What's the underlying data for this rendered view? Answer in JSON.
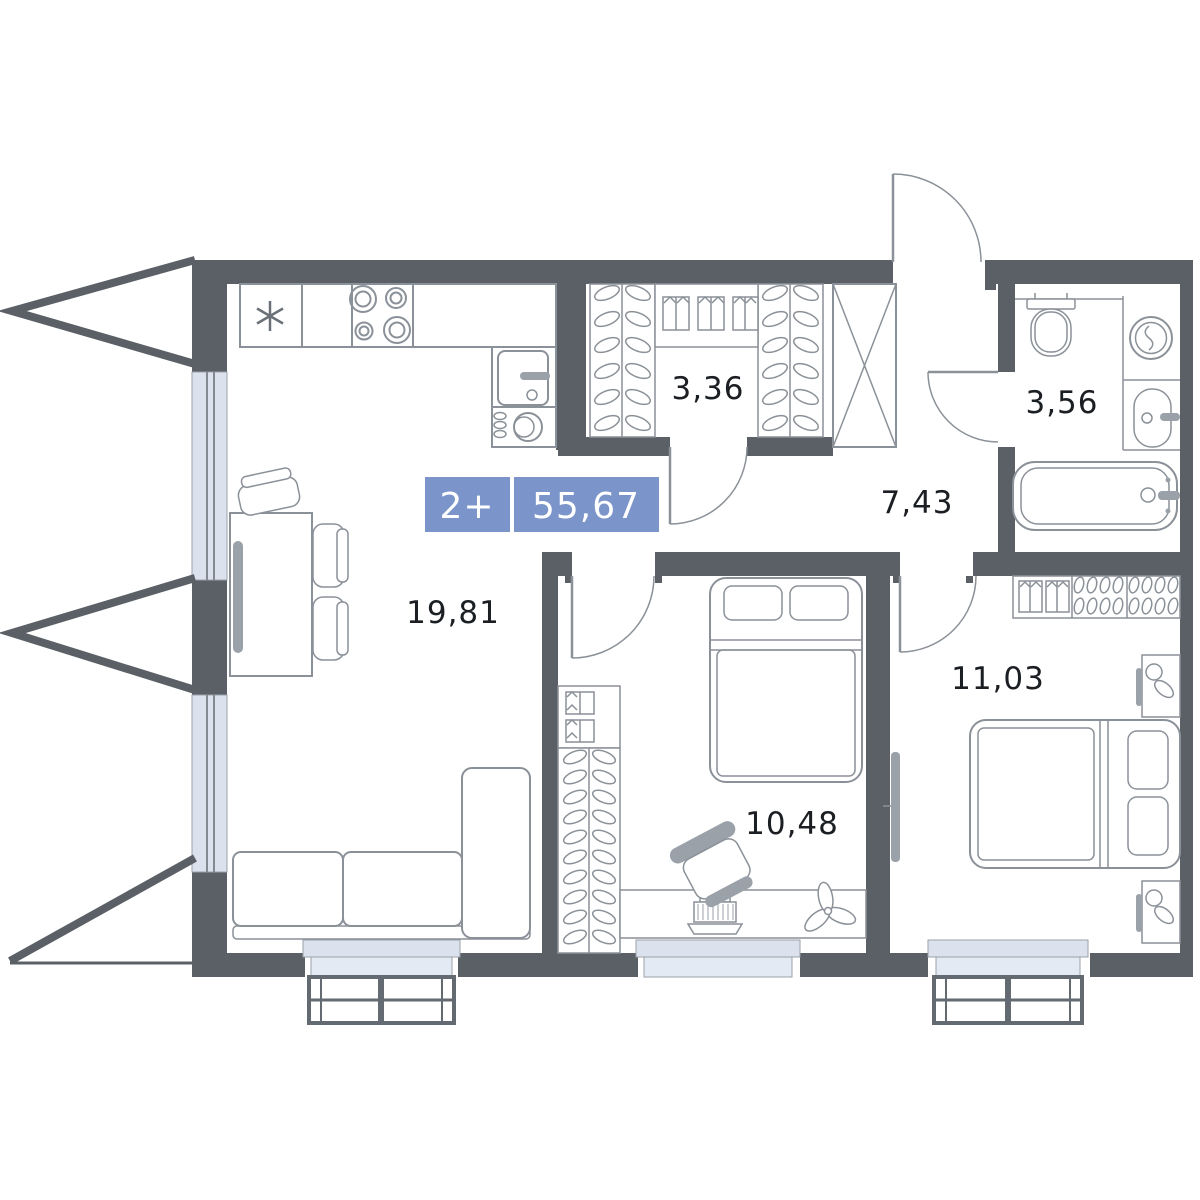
{
  "plan": {
    "badge": {
      "rooms": "2+",
      "total_area": "55,67"
    },
    "areas": {
      "living_kitchen": "19,81",
      "wardrobe": "3,36",
      "bathroom": "3,56",
      "hallway": "7,43",
      "bedroom_small": "10,48",
      "bedroom_large": "11,03"
    }
  },
  "colors": {
    "wall": "#5b6066",
    "outline": "#8b9198",
    "outline_dark": "#646a71",
    "accent": "#dbe2ee",
    "accent_light": "#e4eaf3",
    "furniture": "#9aa1a9",
    "badge_bg": "#7b94c9",
    "label_text": "#1b1e22"
  }
}
